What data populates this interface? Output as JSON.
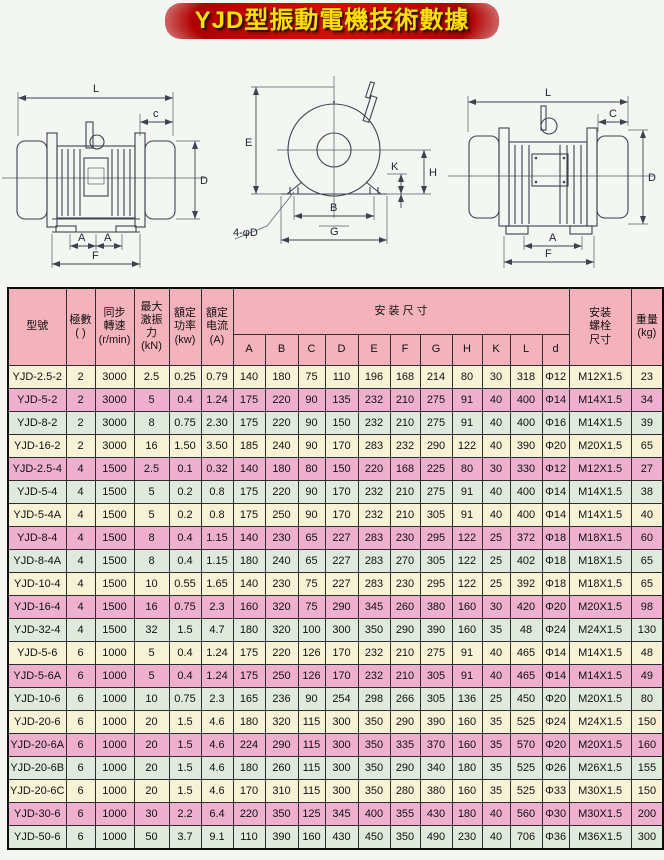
{
  "title": "YJD型振動電機技術數據",
  "drawings": {
    "left": {
      "name": "motor-side-view-left",
      "labels": {
        "L": "L",
        "c": "c",
        "D": "D",
        "A1": "A",
        "A2": "A",
        "F": "F"
      }
    },
    "middle": {
      "name": "motor-end-view",
      "labels": {
        "E": "E",
        "K": "K",
        "H": "H",
        "B": "B",
        "G": "G",
        "holes": "4-φD"
      }
    },
    "right": {
      "name": "motor-side-view-right",
      "labels": {
        "L": "L",
        "C": "C",
        "D": "D",
        "A": "A",
        "F": "F"
      }
    }
  },
  "table": {
    "header_color": "#f4b3bc",
    "row_colors": [
      "#f6f2d5",
      "#efb0cf",
      "#dfe9dc"
    ],
    "headers": {
      "model": "型號",
      "poles": "極數\n(  )",
      "speed": "同步\n轉速\n(r/min)",
      "force": "最大\n激振\n力\n(kN)",
      "power": "額定\n功率\n(kw)",
      "current": "額定\n电流\n(A)",
      "install": "安 装 尺 寸",
      "dims": [
        "A",
        "B",
        "C",
        "D",
        "E",
        "F",
        "G",
        "H",
        "K",
        "L",
        "d"
      ],
      "bolt": "安装\n螺栓\n尺寸",
      "weight": "重量\n(kg)"
    },
    "rows": [
      [
        "YJD-2.5-2",
        "2",
        "3000",
        "2.5",
        "0.25",
        "0.79",
        "140",
        "180",
        "75",
        "110",
        "196",
        "168",
        "214",
        "80",
        "30",
        "318",
        "Φ12",
        "M12X1.5",
        "23"
      ],
      [
        "YJD-5-2",
        "2",
        "3000",
        "5",
        "0.4",
        "1.24",
        "175",
        "220",
        "90",
        "135",
        "232",
        "210",
        "275",
        "91",
        "40",
        "400",
        "Φ14",
        "M14X1.5",
        "34"
      ],
      [
        "YJD-8-2",
        "2",
        "3000",
        "8",
        "0.75",
        "2.30",
        "175",
        "220",
        "90",
        "150",
        "232",
        "210",
        "275",
        "91",
        "40",
        "400",
        "Φ16",
        "M14X1.5",
        "39"
      ],
      [
        "YJD-16-2",
        "2",
        "3000",
        "16",
        "1.50",
        "3.50",
        "185",
        "240",
        "90",
        "170",
        "283",
        "232",
        "290",
        "122",
        "40",
        "390",
        "Φ20",
        "M20X1.5",
        "65"
      ],
      [
        "YJD-2.5-4",
        "4",
        "1500",
        "2.5",
        "0.1",
        "0.32",
        "140",
        "180",
        "80",
        "150",
        "220",
        "168",
        "225",
        "80",
        "30",
        "330",
        "Φ12",
        "M12X1.5",
        "27"
      ],
      [
        "YJD-5-4",
        "4",
        "1500",
        "5",
        "0.2",
        "0.8",
        "175",
        "220",
        "90",
        "170",
        "232",
        "210",
        "275",
        "91",
        "40",
        "400",
        "Φ14",
        "M14X1.5",
        "38"
      ],
      [
        "YJD-5-4A",
        "4",
        "1500",
        "5",
        "0.2",
        "0.8",
        "175",
        "250",
        "90",
        "170",
        "232",
        "210",
        "305",
        "91",
        "40",
        "400",
        "Φ14",
        "M14X1.5",
        "40"
      ],
      [
        "YJD-8-4",
        "4",
        "1500",
        "8",
        "0.4",
        "1.15",
        "140",
        "230",
        "65",
        "227",
        "283",
        "230",
        "295",
        "122",
        "25",
        "372",
        "Φ18",
        "M18X1.5",
        "60"
      ],
      [
        "YJD-8-4A",
        "4",
        "1500",
        "8",
        "0.4",
        "1.15",
        "180",
        "240",
        "65",
        "227",
        "283",
        "270",
        "305",
        "122",
        "25",
        "402",
        "Φ18",
        "M18X1.5",
        "65"
      ],
      [
        "YJD-10-4",
        "4",
        "1500",
        "10",
        "0.55",
        "1.65",
        "140",
        "230",
        "75",
        "227",
        "283",
        "230",
        "295",
        "122",
        "25",
        "392",
        "Φ18",
        "M18X1.5",
        "65"
      ],
      [
        "YJD-16-4",
        "4",
        "1500",
        "16",
        "0.75",
        "2.3",
        "160",
        "320",
        "75",
        "290",
        "345",
        "260",
        "380",
        "160",
        "30",
        "420",
        "Φ20",
        "M20X1.5",
        "98"
      ],
      [
        "YJD-32-4",
        "4",
        "1500",
        "32",
        "1.5",
        "4.7",
        "180",
        "320",
        "100",
        "300",
        "350",
        "290",
        "390",
        "160",
        "35",
        "48",
        "Φ24",
        "M24X1.5",
        "130"
      ],
      [
        "YJD-5-6",
        "6",
        "1000",
        "5",
        "0.4",
        "1.24",
        "175",
        "220",
        "126",
        "170",
        "232",
        "210",
        "275",
        "91",
        "40",
        "465",
        "Φ14",
        "M14X1.5",
        "48"
      ],
      [
        "YJD-5-6A",
        "6",
        "1000",
        "5",
        "0.4",
        "1.24",
        "175",
        "250",
        "126",
        "170",
        "232",
        "210",
        "305",
        "91",
        "40",
        "465",
        "Φ14",
        "M14X1.5",
        "49"
      ],
      [
        "YJD-10-6",
        "6",
        "1000",
        "10",
        "0.75",
        "2.3",
        "165",
        "236",
        "90",
        "254",
        "298",
        "266",
        "305",
        "136",
        "25",
        "450",
        "Φ20",
        "M20X1.5",
        "80"
      ],
      [
        "YJD-20-6",
        "6",
        "1000",
        "20",
        "1.5",
        "4.6",
        "180",
        "320",
        "115",
        "300",
        "350",
        "290",
        "390",
        "160",
        "35",
        "525",
        "Φ24",
        "M24X1.5",
        "150"
      ],
      [
        "YJD-20-6A",
        "6",
        "1000",
        "20",
        "1.5",
        "4.6",
        "224",
        "290",
        "115",
        "300",
        "350",
        "335",
        "370",
        "160",
        "35",
        "570",
        "Φ20",
        "M20X1.5",
        "160"
      ],
      [
        "YJD-20-6B",
        "6",
        "1000",
        "20",
        "1.5",
        "4.6",
        "180",
        "260",
        "115",
        "300",
        "350",
        "290",
        "340",
        "180",
        "35",
        "525",
        "Φ26",
        "M26X1.5",
        "155"
      ],
      [
        "YJD-20-6C",
        "6",
        "1000",
        "20",
        "1.5",
        "4.6",
        "170",
        "310",
        "115",
        "300",
        "350",
        "280",
        "380",
        "160",
        "35",
        "525",
        "Φ33",
        "M30X1.5",
        "150"
      ],
      [
        "YJD-30-6",
        "6",
        "1000",
        "30",
        "2.2",
        "6.4",
        "220",
        "350",
        "125",
        "345",
        "400",
        "355",
        "430",
        "180",
        "40",
        "560",
        "Φ30",
        "M30X1.5",
        "200"
      ],
      [
        "YJD-50-6",
        "6",
        "1000",
        "50",
        "3.7",
        "9.1",
        "110",
        "390",
        "160",
        "430",
        "450",
        "350",
        "490",
        "230",
        "40",
        "706",
        "Φ36",
        "M36X1.5",
        "300"
      ]
    ]
  }
}
